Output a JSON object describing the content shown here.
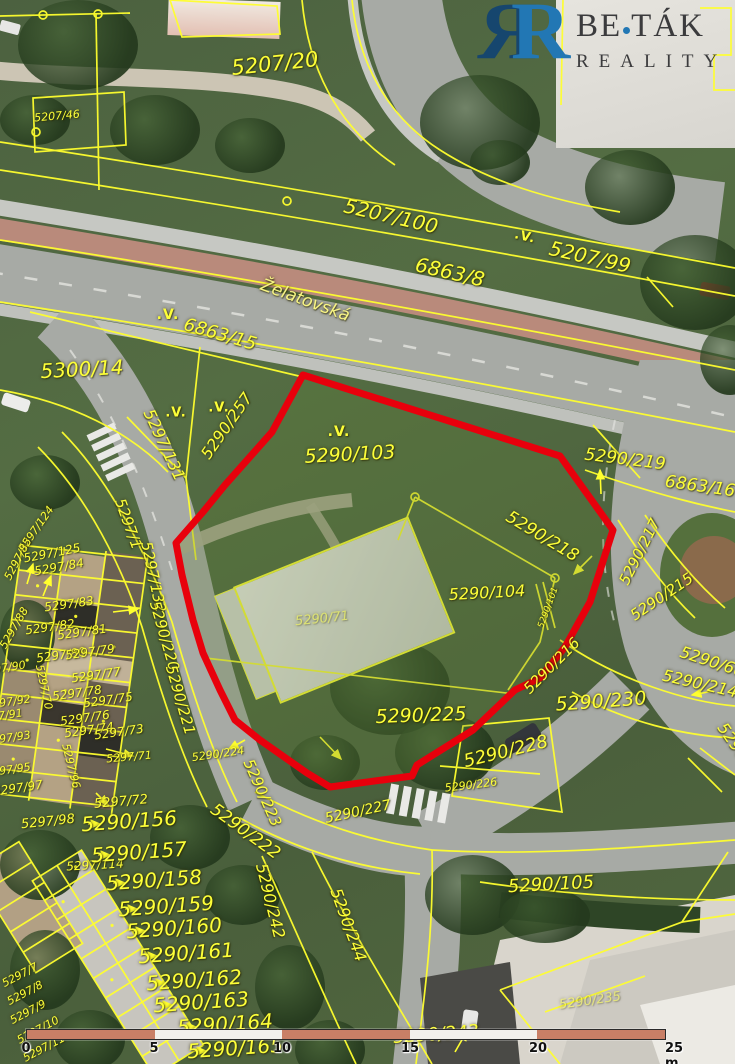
{
  "logo": {
    "monogram": "R",
    "name_a": "BE",
    "name_b": "TÁK",
    "subtitle": "REALITY"
  },
  "map": {
    "red_outline_points": "303,375 560,456 613,530 590,602 565,647 540,678 515,690 473,730 417,765 412,776 330,787 307,773 260,740 235,720 220,690 203,653 193,620 182,575 176,543 203,512 225,485 272,432",
    "scale_bar": {
      "segment_colors": [
        "#c97f66",
        "#f2f0ec",
        "#c97f66",
        "#f2f0ec",
        "#c97f66"
      ],
      "ticks": [
        {
          "t": "0",
          "x": 0
        },
        {
          "t": "5",
          "x": 128
        },
        {
          "t": "10",
          "x": 256
        },
        {
          "t": "15",
          "x": 384
        },
        {
          "t": "20",
          "x": 512
        },
        {
          "t": "25 m",
          "x": 648
        }
      ]
    },
    "labels": [
      {
        "t": "5207/46",
        "x": 57,
        "y": 116,
        "r": -5,
        "s": 11
      },
      {
        "t": "5207/20",
        "x": 275,
        "y": 64,
        "r": -6,
        "s": 21
      },
      {
        "t": "5207/100",
        "x": 391,
        "y": 216,
        "r": 13,
        "s": 20
      },
      {
        "t": "6863/8",
        "x": 450,
        "y": 272,
        "r": 13,
        "s": 20
      },
      {
        "t": "5207/99",
        "x": 590,
        "y": 257,
        "r": 13,
        "s": 20
      },
      {
        "t": ".V.",
        "x": 525,
        "y": 237,
        "r": 13,
        "s": 13,
        "cls": "mark"
      },
      {
        "t": "Želatovská",
        "x": 305,
        "y": 301,
        "r": 20,
        "s": 17,
        "cls": "street"
      },
      {
        "t": ".V.",
        "x": 168,
        "y": 315,
        "r": 0,
        "s": 14,
        "cls": "mark"
      },
      {
        "t": "6863/15",
        "x": 220,
        "y": 335,
        "r": 16,
        "s": 18
      },
      {
        "t": "5300/14",
        "x": 82,
        "y": 369,
        "r": -3,
        "s": 20
      },
      {
        "t": ".V.",
        "x": 176,
        "y": 413,
        "r": 0,
        "s": 13,
        "cls": "mark"
      },
      {
        "t": ".V.",
        "x": 219,
        "y": 408,
        "r": 0,
        "s": 13,
        "cls": "mark"
      },
      {
        "t": "5297/131",
        "x": 164,
        "y": 445,
        "r": 65,
        "s": 16
      },
      {
        "t": "5290/257",
        "x": 227,
        "y": 426,
        "r": -55,
        "s": 16
      },
      {
        "t": ".V.",
        "x": 339,
        "y": 432,
        "r": 0,
        "s": 14,
        "cls": "mark"
      },
      {
        "t": "5290/103",
        "x": 350,
        "y": 455,
        "r": -3,
        "s": 19
      },
      {
        "t": "5290/219",
        "x": 625,
        "y": 460,
        "r": 7,
        "s": 17
      },
      {
        "t": "6863/16",
        "x": 700,
        "y": 487,
        "r": 8,
        "s": 17
      },
      {
        "t": "5290/218",
        "x": 542,
        "y": 537,
        "r": 31,
        "s": 17
      },
      {
        "t": "5290/217",
        "x": 640,
        "y": 552,
        "r": -63,
        "s": 15
      },
      {
        "t": "5290/215",
        "x": 662,
        "y": 597,
        "r": -34,
        "s": 15
      },
      {
        "t": "5290/101",
        "x": 549,
        "y": 608,
        "r": -70,
        "s": 9
      },
      {
        "t": "5290/104",
        "x": 487,
        "y": 593,
        "r": -3,
        "s": 16
      },
      {
        "t": "5297/1",
        "x": 128,
        "y": 524,
        "r": 70,
        "s": 15
      },
      {
        "t": "5297/132",
        "x": 153,
        "y": 577,
        "r": 78,
        "s": 15
      },
      {
        "t": "5290/220",
        "x": 164,
        "y": 636,
        "r": 74,
        "s": 15
      },
      {
        "t": "5290/221",
        "x": 180,
        "y": 700,
        "r": 74,
        "s": 15
      },
      {
        "t": "5290/71",
        "x": 322,
        "y": 619,
        "r": -6,
        "s": 13,
        "cls": "faint"
      },
      {
        "t": "5290/216",
        "x": 552,
        "y": 666,
        "r": -45,
        "s": 15
      },
      {
        "t": "5290/230",
        "x": 601,
        "y": 702,
        "r": -4,
        "s": 19
      },
      {
        "t": "5290/66",
        "x": 712,
        "y": 662,
        "r": 18,
        "s": 16
      },
      {
        "t": "5290/214",
        "x": 700,
        "y": 684,
        "r": 13,
        "s": 16
      },
      {
        "t": "5290/21",
        "x": 740,
        "y": 752,
        "r": 55,
        "s": 16
      },
      {
        "t": "5290/225",
        "x": 421,
        "y": 716,
        "r": -2,
        "s": 19
      },
      {
        "t": "5290/228",
        "x": 506,
        "y": 752,
        "r": -14,
        "s": 18
      },
      {
        "t": "5290/226",
        "x": 471,
        "y": 785,
        "r": -7,
        "s": 11
      },
      {
        "t": "5290/227",
        "x": 358,
        "y": 812,
        "r": -12,
        "s": 14
      },
      {
        "t": "5290/224",
        "x": 218,
        "y": 754,
        "r": -8,
        "s": 11
      },
      {
        "t": "5290/223",
        "x": 262,
        "y": 793,
        "r": 66,
        "s": 15
      },
      {
        "t": "5290/222",
        "x": 245,
        "y": 832,
        "r": 36,
        "s": 17
      },
      {
        "t": "5297/124",
        "x": 36,
        "y": 529,
        "r": -55,
        "s": 11
      },
      {
        "t": "5297/85",
        "x": 18,
        "y": 559,
        "r": -62,
        "s": 11
      },
      {
        "t": "5297/125",
        "x": 52,
        "y": 553,
        "r": -11,
        "s": 12
      },
      {
        "t": "5297/84",
        "x": 59,
        "y": 567,
        "r": -10,
        "s": 12
      },
      {
        "t": "5297/83",
        "x": 69,
        "y": 604,
        "r": -8,
        "s": 12
      },
      {
        "t": "5297/88",
        "x": 14,
        "y": 628,
        "r": -60,
        "s": 11
      },
      {
        "t": "5297/82",
        "x": 50,
        "y": 627,
        "r": -8,
        "s": 12
      },
      {
        "t": "5297/81",
        "x": 82,
        "y": 632,
        "r": -8,
        "s": 12
      },
      {
        "t": "5297/80",
        "x": 61,
        "y": 655,
        "r": -8,
        "s": 12
      },
      {
        "t": "5297/79",
        "x": 90,
        "y": 652,
        "r": -8,
        "s": 12
      },
      {
        "t": "5297/77",
        "x": 96,
        "y": 675,
        "r": -8,
        "s": 12
      },
      {
        "t": "5297/78",
        "x": 77,
        "y": 693,
        "r": -8,
        "s": 12
      },
      {
        "t": "5297/75",
        "x": 108,
        "y": 700,
        "r": -8,
        "s": 12
      },
      {
        "t": "5297/76",
        "x": 85,
        "y": 718,
        "r": -8,
        "s": 12
      },
      {
        "t": "5297/74",
        "x": 89,
        "y": 730,
        "r": -8,
        "s": 12
      },
      {
        "t": "5297/73",
        "x": 119,
        "y": 732,
        "r": -8,
        "s": 12
      },
      {
        "t": "5297/70",
        "x": 44,
        "y": 687,
        "r": 78,
        "s": 11
      },
      {
        "t": "5297/90",
        "x": 3,
        "y": 668,
        "r": -8,
        "s": 11
      },
      {
        "t": "5297/92",
        "x": 8,
        "y": 702,
        "r": -8,
        "s": 11
      },
      {
        "t": "5297/91",
        "x": 0,
        "y": 716,
        "r": -8,
        "s": 11
      },
      {
        "t": "5297/93",
        "x": 8,
        "y": 738,
        "r": -8,
        "s": 11
      },
      {
        "t": "5297/95",
        "x": 8,
        "y": 770,
        "r": -8,
        "s": 11
      },
      {
        "t": "5297/96",
        "x": 71,
        "y": 766,
        "r": 76,
        "s": 11
      },
      {
        "t": "5297/97",
        "x": 18,
        "y": 788,
        "r": -8,
        "s": 12
      },
      {
        "t": "5297/71",
        "x": 129,
        "y": 757,
        "r": -5,
        "s": 11
      },
      {
        "t": "5297/72",
        "x": 121,
        "y": 802,
        "r": -5,
        "s": 13
      },
      {
        "t": "5297/98",
        "x": 48,
        "y": 822,
        "r": -6,
        "s": 13
      },
      {
        "t": "5297/114",
        "x": 95,
        "y": 865,
        "r": -3,
        "s": 12
      },
      {
        "t": "5290/156",
        "x": 129,
        "y": 821,
        "r": -4,
        "s": 20
      },
      {
        "t": "5290/157",
        "x": 139,
        "y": 852,
        "r": -4,
        "s": 20
      },
      {
        "t": "5290/158",
        "x": 154,
        "y": 880,
        "r": -4,
        "s": 20
      },
      {
        "t": "5290/159",
        "x": 166,
        "y": 906,
        "r": -4,
        "s": 20
      },
      {
        "t": "5290/160",
        "x": 174,
        "y": 928,
        "r": -4,
        "s": 20
      },
      {
        "t": "5290/161",
        "x": 186,
        "y": 953,
        "r": -4,
        "s": 20
      },
      {
        "t": "5290/162",
        "x": 194,
        "y": 980,
        "r": -4,
        "s": 20
      },
      {
        "t": "5290/163",
        "x": 201,
        "y": 1002,
        "r": -4,
        "s": 20
      },
      {
        "t": "5290/164",
        "x": 225,
        "y": 1024,
        "r": -4,
        "s": 20
      },
      {
        "t": "5290/165",
        "x": 235,
        "y": 1048,
        "r": -4,
        "s": 20
      },
      {
        "t": "5290/242",
        "x": 270,
        "y": 901,
        "r": 76,
        "s": 16
      },
      {
        "t": "5290/244",
        "x": 348,
        "y": 925,
        "r": 70,
        "s": 16
      },
      {
        "t": "5290/243",
        "x": 436,
        "y": 1035,
        "r": -4,
        "s": 18
      },
      {
        "t": "5290/105",
        "x": 551,
        "y": 885,
        "r": -3,
        "s": 18
      },
      {
        "t": "5290/235",
        "x": 590,
        "y": 1001,
        "r": -8,
        "s": 13,
        "cls": "faint"
      },
      {
        "t": "5297/7",
        "x": 20,
        "y": 975,
        "r": -28,
        "s": 11
      },
      {
        "t": "5297/8",
        "x": 25,
        "y": 993,
        "r": -28,
        "s": 11
      },
      {
        "t": "5297/9",
        "x": 28,
        "y": 1012,
        "r": -28,
        "s": 11
      },
      {
        "t": "5297/10",
        "x": 38,
        "y": 1030,
        "r": -28,
        "s": 11
      },
      {
        "t": "5297/11",
        "x": 44,
        "y": 1048,
        "r": -28,
        "s": 11
      }
    ]
  }
}
